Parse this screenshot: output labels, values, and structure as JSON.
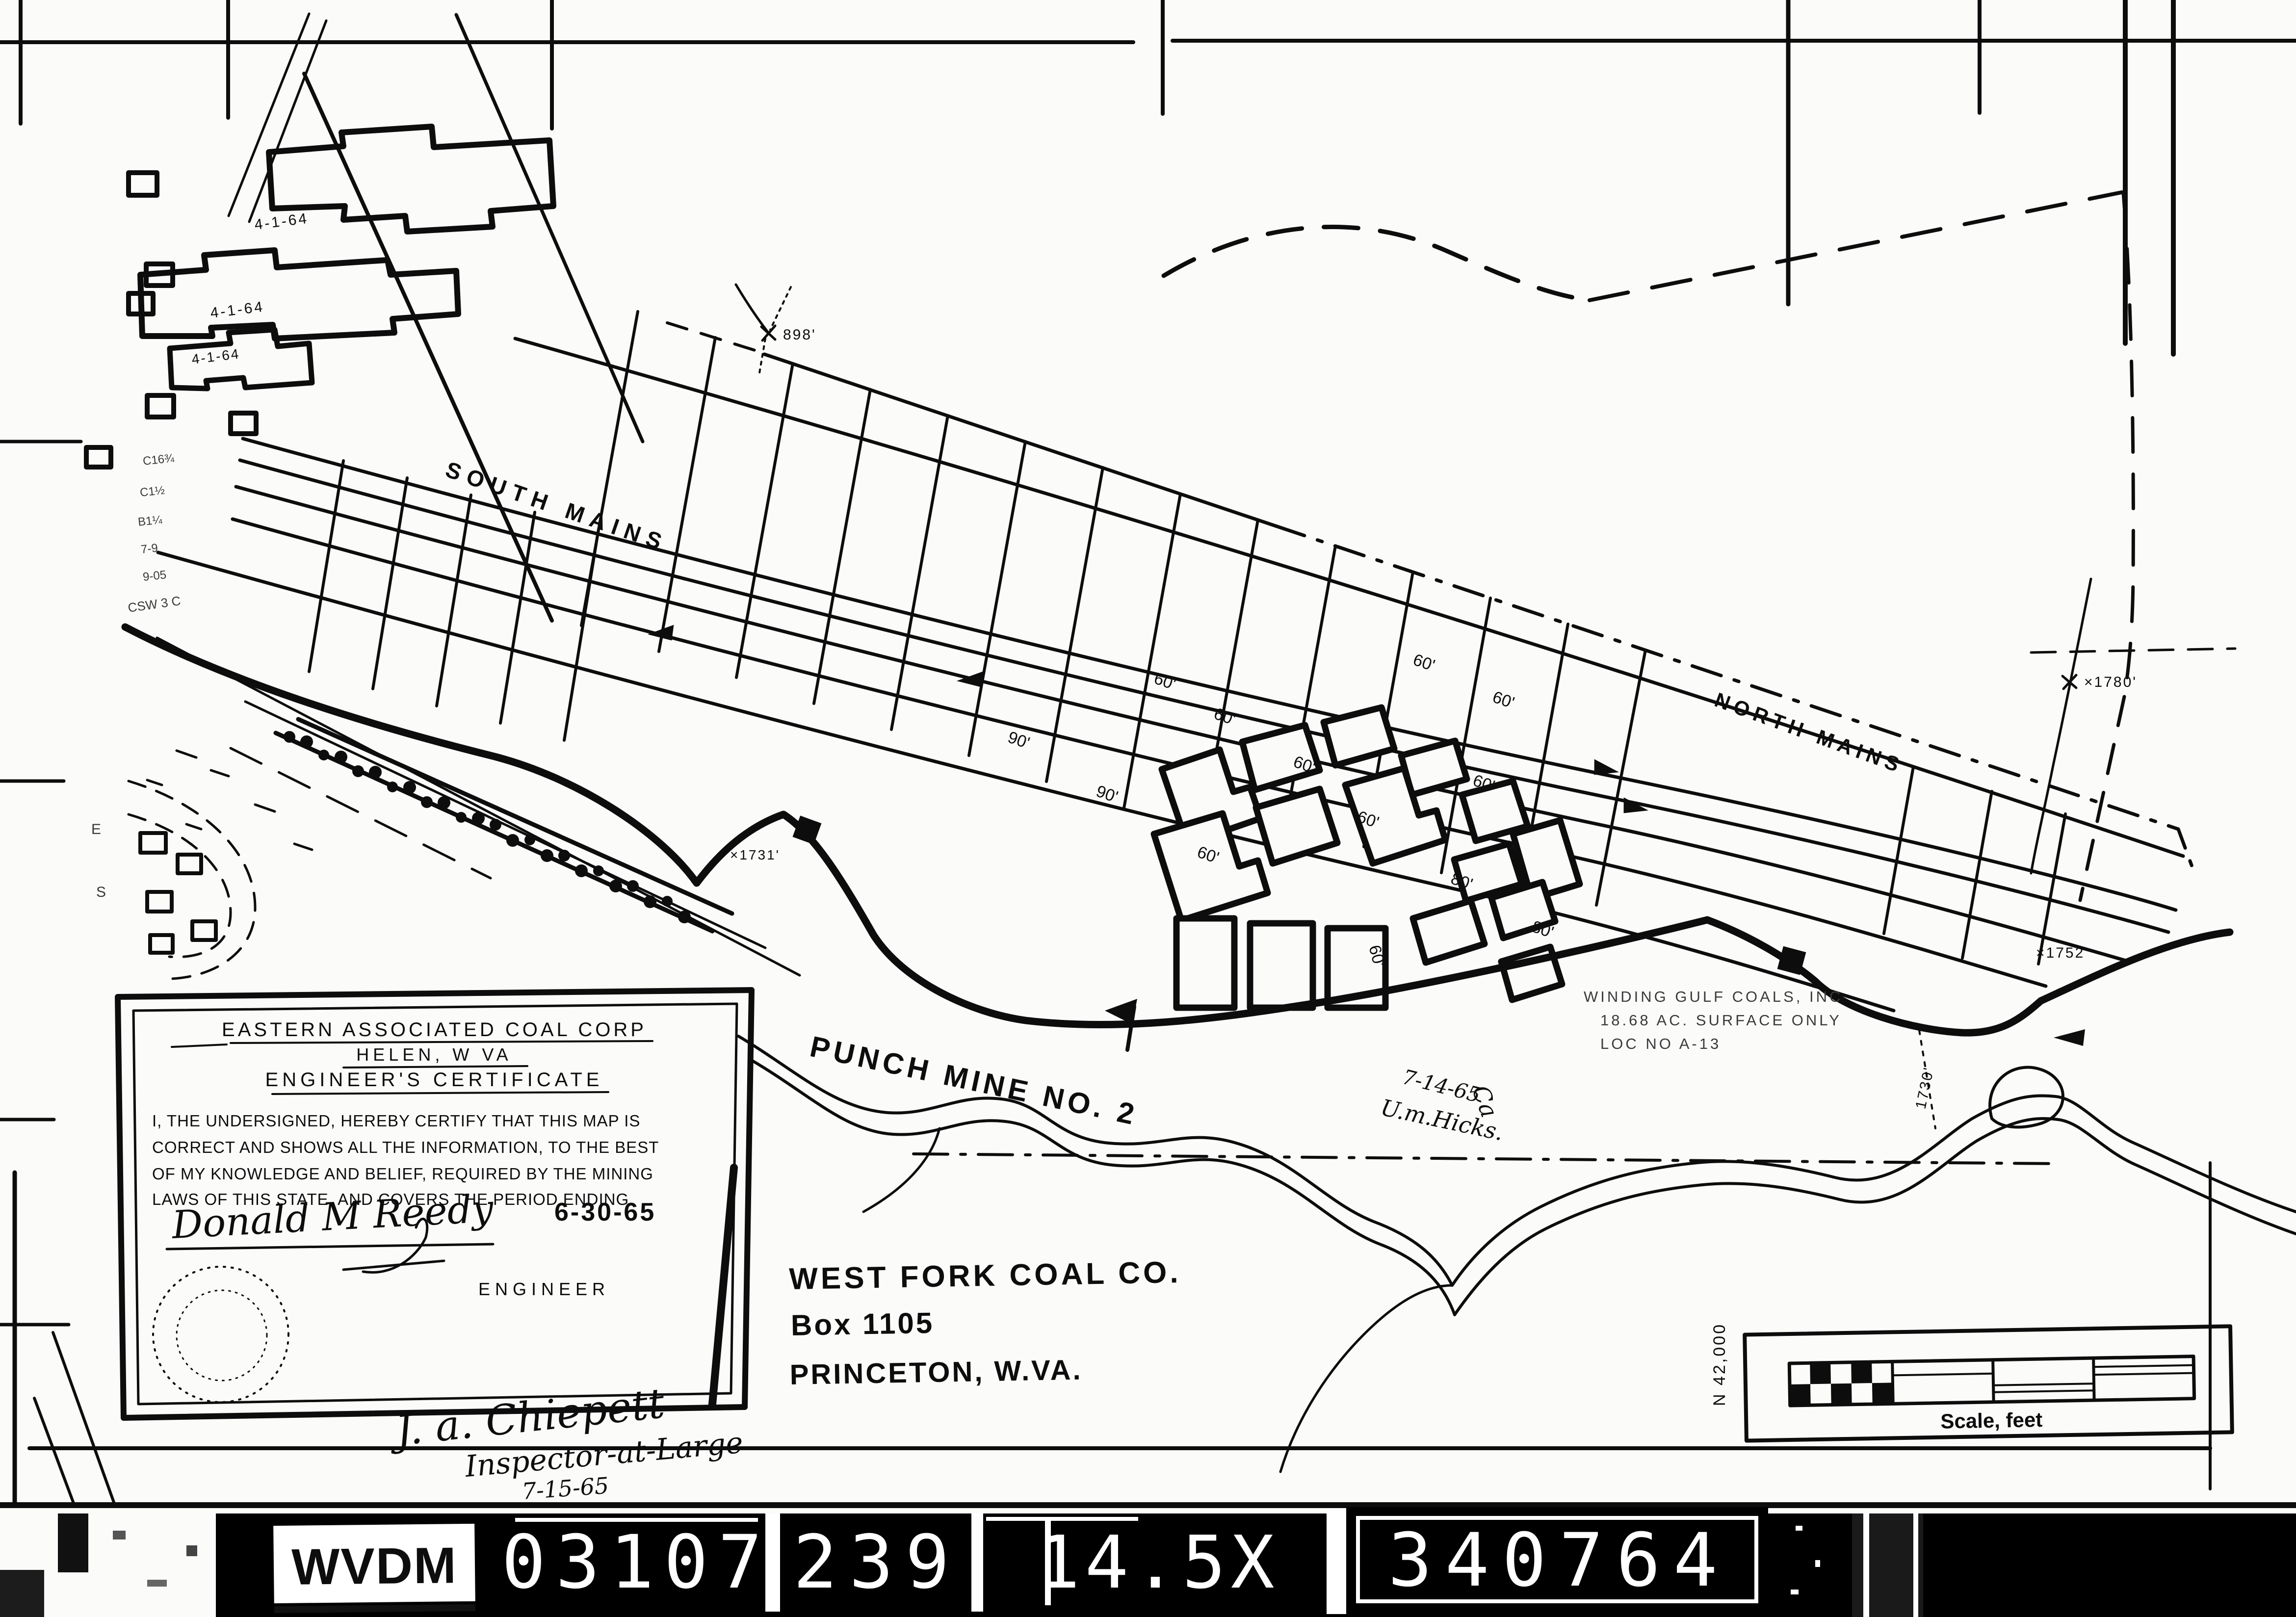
{
  "certificate": {
    "company": "EASTERN ASSOCIATED COAL CORP",
    "location": "HELEN, W VA",
    "title": "ENGINEER'S CERTIFICATE",
    "body_lines": [
      "I, THE UNDERSIGNED, HEREBY CERTIFY THAT THIS MAP IS",
      "CORRECT AND SHOWS ALL THE INFORMATION, TO THE BEST",
      "OF MY KNOWLEDGE AND BELIEF, REQUIRED BY THE MINING",
      "LAWS OF THIS STATE, AND COVERS THE PERIOD ENDING"
    ],
    "period_ending": "6-30-65",
    "signature": "Donald M Reedy",
    "signer_title": "ENGINEER"
  },
  "owner": {
    "company": "WEST FORK COAL CO.",
    "address": "Box 1105",
    "city": "PRINCETON, W.VA."
  },
  "mine": {
    "name": "PUNCH MINE NO. 2",
    "south_mains": "SOUTH MAINS",
    "north_mains": "NORTH MAINS"
  },
  "survey": {
    "date": "7-14-65",
    "surveyor": "U.m.Hicks."
  },
  "inspector": {
    "signature": "J. a. Chiepett",
    "title": "Inspector-at-Large",
    "date": "7-15-65"
  },
  "adjacent": {
    "line1": "WINDING GULF COALS, INC",
    "line2": "18.68 AC. SURFACE ONLY",
    "line3": "LOC  NO   A-13"
  },
  "scale": {
    "label": "Scale, feet",
    "northing": "N 42,000"
  },
  "elevations": {
    "e898": "898'",
    "e1780": "×1780'",
    "e1752": "×1752'",
    "e1731": "×1731'",
    "e1730": "1730'"
  },
  "panel_dates": {
    "d1": "4-1-64",
    "d2": "4-1-64",
    "d3": "4-1-64"
  },
  "notes": {
    "n1": "C16¾",
    "n2": "C1½",
    "n3": "B1¼",
    "n4": "7-9",
    "n5": "9-05",
    "n6": "CSW 3 C",
    "e1": "E",
    "e2": "S"
  },
  "distances": {
    "a": "90'",
    "b": "90'",
    "c": "60'",
    "d": "60'",
    "e": "60'",
    "f": "60'",
    "g": "60'",
    "h": "60'",
    "i": "60'",
    "j": "60'",
    "k": "60'",
    "l": "80'",
    "m": "80'"
  },
  "film_strip": {
    "agency": "WVDM",
    "code1": "03107",
    "code2": "239",
    "code3": "14.5X",
    "code4": "340764"
  }
}
